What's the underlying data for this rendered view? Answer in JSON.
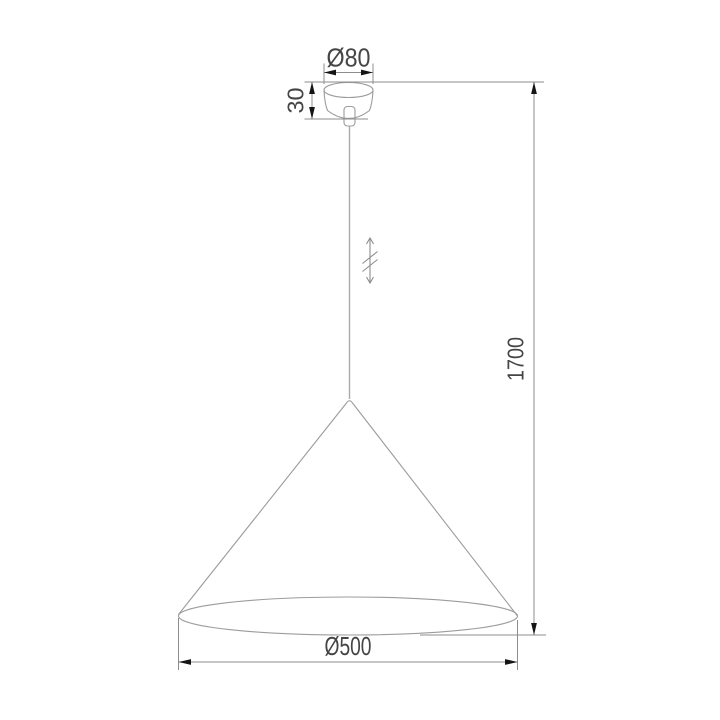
{
  "diagram": {
    "labels": {
      "canopy_diameter": "Ø80",
      "canopy_height": "30",
      "overall_height": "1700",
      "shade_diameter": "Ø500"
    },
    "colors": {
      "background": "#ffffff",
      "product_outline": "#9c9c9c",
      "dimension_line": "#8d8d8d",
      "arrowhead": "#151515",
      "label_text": "#454545"
    }
  }
}
